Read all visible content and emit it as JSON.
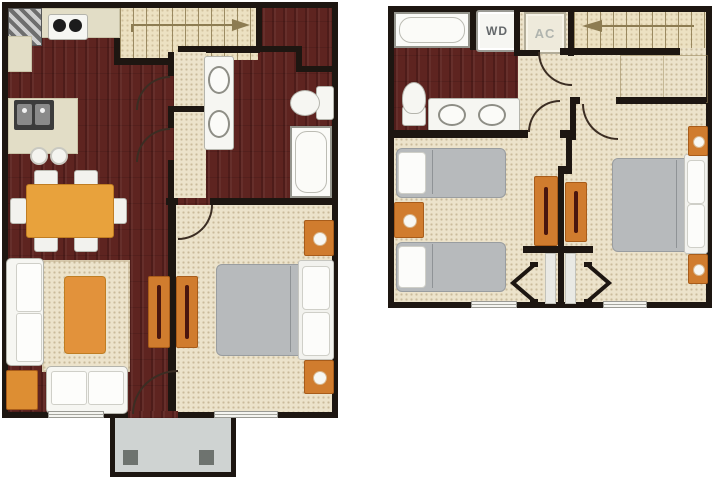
{
  "page": {
    "background": "#ffffff",
    "kind": "two-story floor plan"
  },
  "colors": {
    "wall": "#1d1611",
    "wood": "#5e2420",
    "carpet": "#ece3cb",
    "orange": "#d07c2e",
    "orange_dark": "#a85c1a",
    "fixture": "#f6f6f2",
    "bed_gray": "#b7babc",
    "porch": "#cfd3d2",
    "counter": "#e2ddc6",
    "line": "#3b2d23",
    "page_bg": "#ffffff"
  },
  "floor1": {
    "name": "first floor",
    "stairs_arrow_direction": "right",
    "features": [
      "kitchen-counter",
      "refrigerator",
      "range-stove",
      "island-with-sink",
      "bar-stools",
      "dining-table-with-six-chairs",
      "area-rug",
      "coffee-table",
      "sofa",
      "loveseat",
      "ottoman",
      "media-console",
      "staircase-up",
      "hallway",
      "double-sink-vanity",
      "toilet",
      "bathtub",
      "closet",
      "queen-bed",
      "nightstands",
      "dresser",
      "entry-door",
      "front-porch",
      "windows"
    ]
  },
  "floor2": {
    "name": "second floor",
    "stairs_arrow_direction": "left",
    "labels": {
      "washer_dryer": "WD",
      "air_conditioner": "AC"
    },
    "features": [
      "bathtub",
      "washer-dryer-closet",
      "ac-closet",
      "staircase-down",
      "toilet",
      "double-sink-vanity",
      "twin-beds",
      "queen-bed",
      "nightstands",
      "sliding-door-closets",
      "open-doors",
      "windows"
    ]
  }
}
